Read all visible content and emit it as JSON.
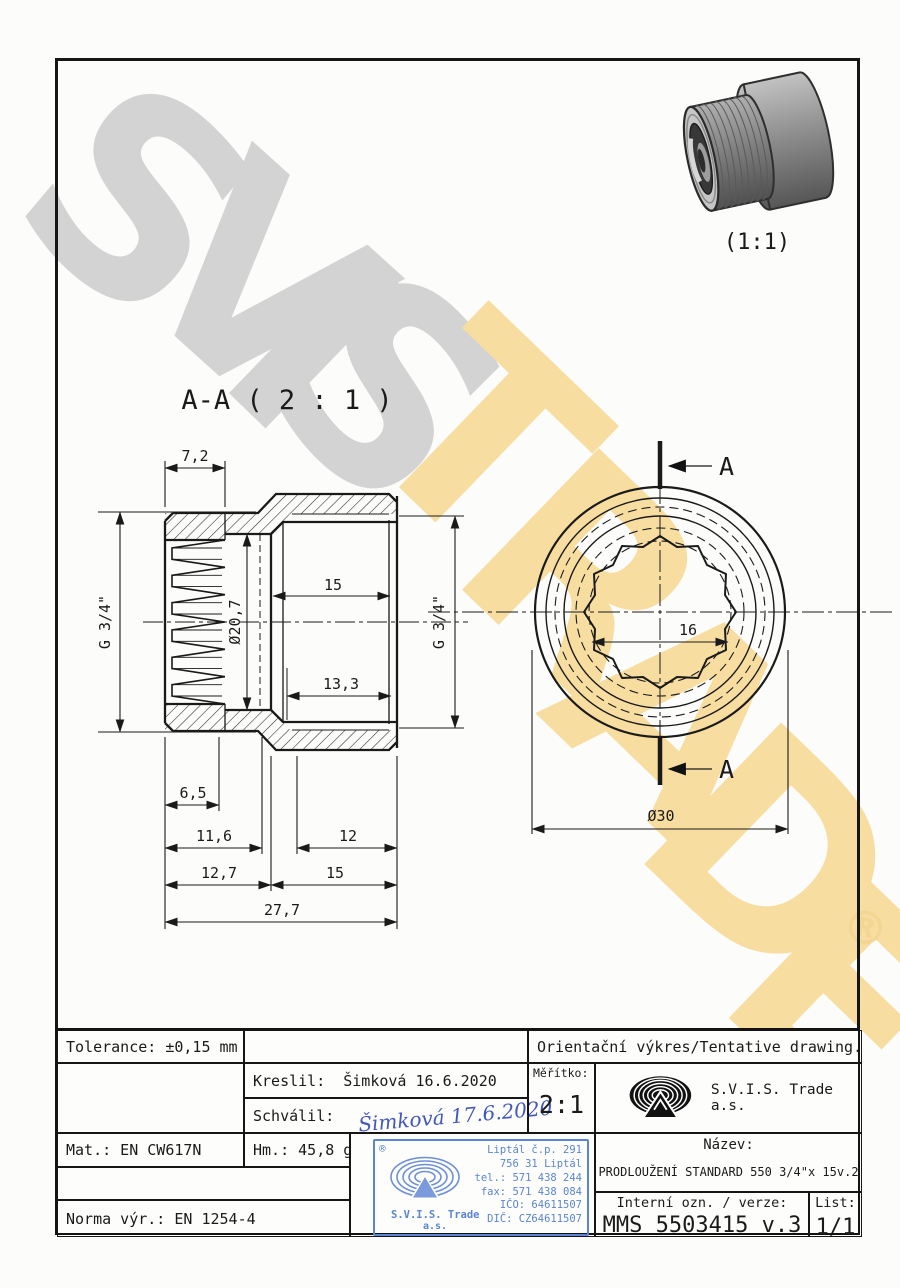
{
  "page": {
    "background": "#fcfcfb",
    "ink": "#1a1a1a"
  },
  "watermark": {
    "gray_letters": [
      "S",
      "V",
      "I",
      "S"
    ],
    "yellow_letters": [
      "T",
      "R",
      "A",
      "D",
      "E"
    ],
    "registered": "®",
    "gray_color": "#d3d3d3",
    "yellow_color": "#f8dda1"
  },
  "render_3d": {
    "scale_label": "(1:1)"
  },
  "section_view": {
    "label": "A-A ( 2 : 1 )",
    "dim_7_2": "7,2",
    "dim_g34_left": "G 3/4\"",
    "dim_bore": "Ø20,7",
    "dim_15_mid": "15",
    "dim_g34_right": "G 3/4\"",
    "dim_13_3": "13,3",
    "dim_6_5": "6,5",
    "dim_11_6": "11,6",
    "dim_12": "12",
    "dim_12_7": "12,7",
    "dim_15_bottom": "15",
    "dim_27_7": "27,7"
  },
  "circle_view": {
    "dim_across_flats": "16",
    "dim_outer": "Ø30",
    "cut_label_top": "A",
    "cut_label_bottom": "A"
  },
  "title_block": {
    "tolerance": "Tolerance: ±0,15 mm",
    "orientation_note": "Orientační výkres/Tentative drawing.",
    "kreslil_label": "Kreslil:",
    "kreslil_value": "Šimková 16.6.2020",
    "schvalil_label": "Schválil:",
    "schvalil_signature": "Šimková 17.6.2020",
    "meritko_label": "Měřítko:",
    "meritko_value": "2:1",
    "company": "S.V.I.S. Trade a.s.",
    "mat": "Mat.: EN CW617N",
    "hm": "Hm.: 45,8 g",
    "norma": "Norma výr.: EN 1254-4",
    "nazev_label": "Název:",
    "nazev_value": "PRODLOUŽENÍ STANDARD 550 3/4\"x 15v.2",
    "interni_label": "Interní ozn. / verze:",
    "interni_value": "MMS 5503415 v.3",
    "list_label": "List:",
    "list_value": "1/1",
    "signature_color": "#4356bd",
    "stamp": {
      "registered": "®",
      "company": "S.V.I.S. Trade",
      "suffix": "a.s.",
      "lines": [
        "Liptál č.p. 291",
        "756 31 Liptál",
        "tel.: 571 438 244",
        "fax: 571 438 084",
        "IČO: 64611507",
        "DIČ: CZ64611507"
      ],
      "blue": "#5b84d4"
    }
  }
}
